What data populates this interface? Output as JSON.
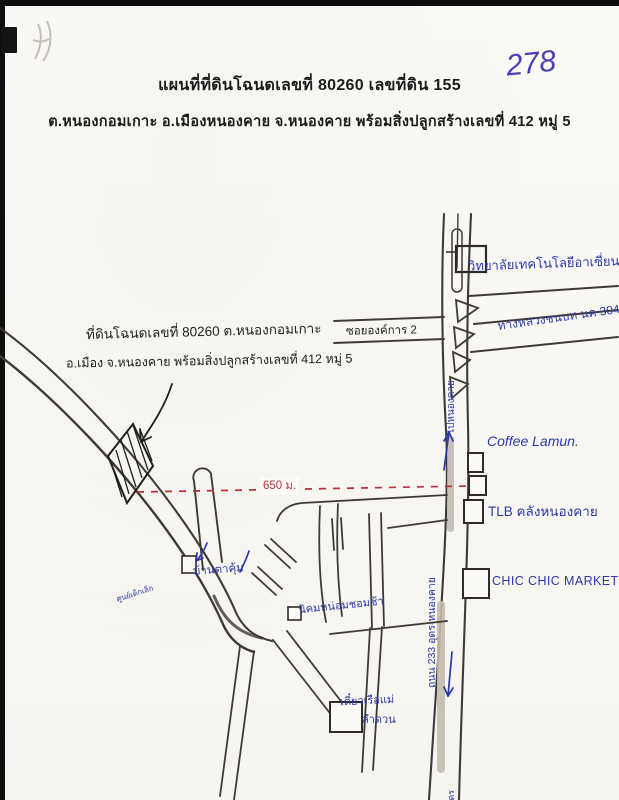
{
  "page": {
    "handwritten_page_number": "278",
    "header_line1": "แผนที่ที่ดินโฉนดเลขที่  80260  เลขที่ดิน  155",
    "header_line2": "ต.หนองกอมเกาะ  อ.เมืองหนองคาย  จ.หนองคาย  พร้อมสิ่งปลูกสร้างเลขที่ 412 หมู่ 5"
  },
  "annotation": {
    "line1": "ที่ดินโฉนดเลขที่ 80260 ต.หนองกอมเกาะ",
    "line2": "อ.เมือง จ.หนองคาย พร้อมสิ่งปลูกสร้างเลขที่ 412 หมู่ 5"
  },
  "measurement": {
    "distance_label": "650 ม."
  },
  "labels": {
    "college": "วิทยาลัยเทคโนโลยีอาเซี่ยน",
    "rural_highway": "ทางหลวงชนบท นค 3045",
    "soi": "ซอยองค์การ 2",
    "to_nongkhai": "ไปหนองคาย",
    "coffee": "Coffee Lamun.",
    "tlb": "TLB คลังหนองคาย",
    "market": "CHIC CHIC MARKET",
    "main_road": "ถนน 233 อุดร-หนองคาย",
    "ban_ta_khum": "บ้านตาคุ้ม",
    "nikhom": "นิคมหน่อมชอมช้า",
    "noodle_line1": "เตี๋ยวเรือแม่",
    "noodle_line2": "ลำดวน",
    "small_left_label": "ศูนย์เด็กเล็ก",
    "to_udon_partial": "อุดร"
  },
  "colors": {
    "ink_blue": "#2b3aa8",
    "ink_black": "#23211f",
    "measure_red": "#b5323c",
    "paper": "#fbfaf6"
  }
}
